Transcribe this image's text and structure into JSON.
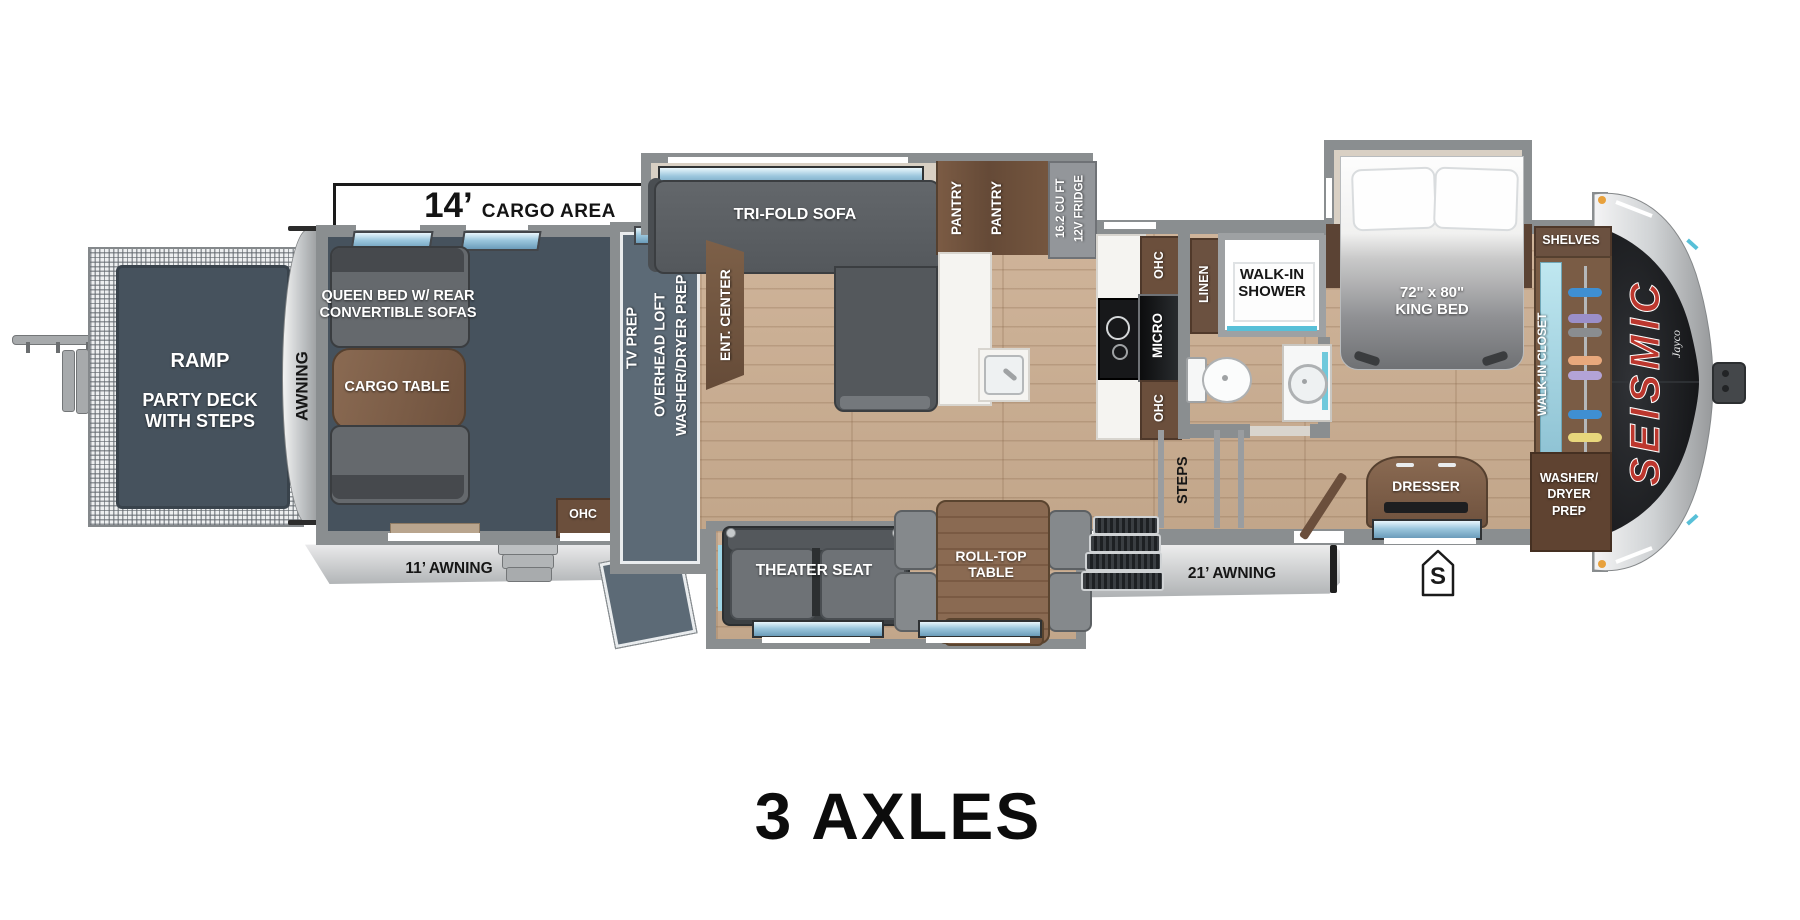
{
  "title": "3 AXLES",
  "brand": {
    "logo": "SEISMIC",
    "sub_logo": "Jayco"
  },
  "dimensions": {
    "cargo_feet": "14’",
    "cargo_text": "CARGO AREA"
  },
  "rear": {
    "ramp": "RAMP",
    "party_deck": "PARTY DECK\nWITH STEPS",
    "awning": "AWNING",
    "awning_11": "11’ AWNING"
  },
  "garage": {
    "queen_bed": "QUEEN BED W/ REAR\nCONVERTIBLE SOFAS",
    "cargo_table": "CARGO TABLE",
    "ohc": "OHC"
  },
  "loft": {
    "tv_prep": "TV PREP",
    "overhead": "OVERHEAD LOFT\nWASHER/DRYER PREP"
  },
  "living": {
    "ent_center": "ENT. CENTER",
    "sofa": "TRI-FOLD SOFA",
    "theater": "THEATER SEAT",
    "table": "ROLL-TOP\nTABLE"
  },
  "kitchen": {
    "pantry1": "PANTRY",
    "pantry2": "PANTRY",
    "fridge": "16.2 CU FT\n12V FRIDGE",
    "ohc_top": "OHC",
    "micro": "MICRO",
    "ohc_bottom": "OHC"
  },
  "bath": {
    "linen": "LINEN",
    "shower": "WALK-IN\nSHOWER"
  },
  "stairs": {
    "label": "STEPS"
  },
  "bedroom": {
    "king_bed": "72\" x 80\"\nKING BED",
    "shelves": "SHELVES",
    "closet": "WALK-IN CLOSET",
    "washer_dryer": "WASHER/\nDRYER\nPREP",
    "dresser": "DRESSER",
    "awning_21": "21’ AWNING"
  },
  "symbols": {
    "s_marker": "S"
  },
  "colors": {
    "wall": "#8a8e90",
    "garage_interior": "#46525d",
    "wood_floor": "#c9ad92",
    "cabinet": "#6b4f3c",
    "accent_aqua": "#58c0d8",
    "brand_red": "#bc372e",
    "cap_black": "#131417"
  }
}
